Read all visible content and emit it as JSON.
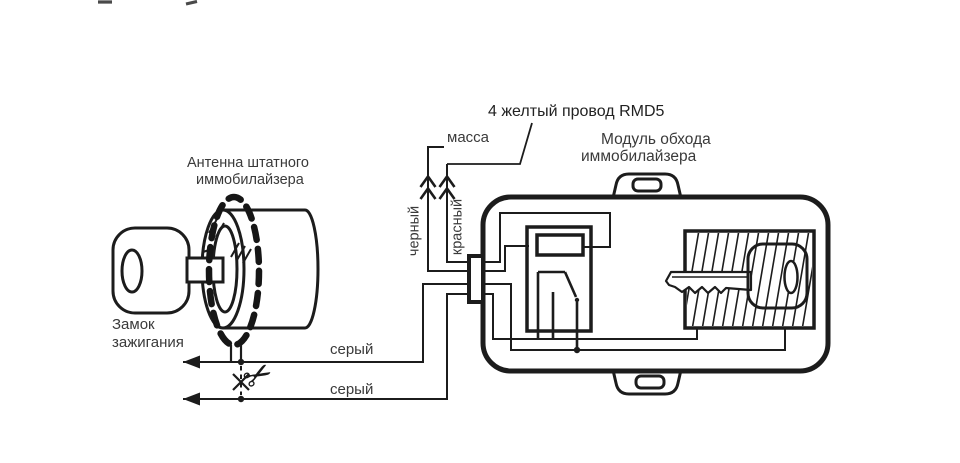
{
  "meta": {
    "background_color": "#ffffff",
    "line_color": "#1c1c1c",
    "text_color": "#3a3a3a"
  },
  "labels": {
    "yellow_wire_note": "4 желтый провод RMD5",
    "ground": "масса",
    "module_title_1": "Модуль обхода",
    "module_title_2": "иммобилайзера",
    "antenna_1": "Антенна штатного",
    "antenna_2": "иммобилайзера",
    "ignition_1": "Замок",
    "ignition_2": "зажигания",
    "wire_black": "черный",
    "wire_red": "красный",
    "wire_gray_1": "серый",
    "wire_gray_2": "серый"
  },
  "icons": {
    "scissors": "✂"
  }
}
